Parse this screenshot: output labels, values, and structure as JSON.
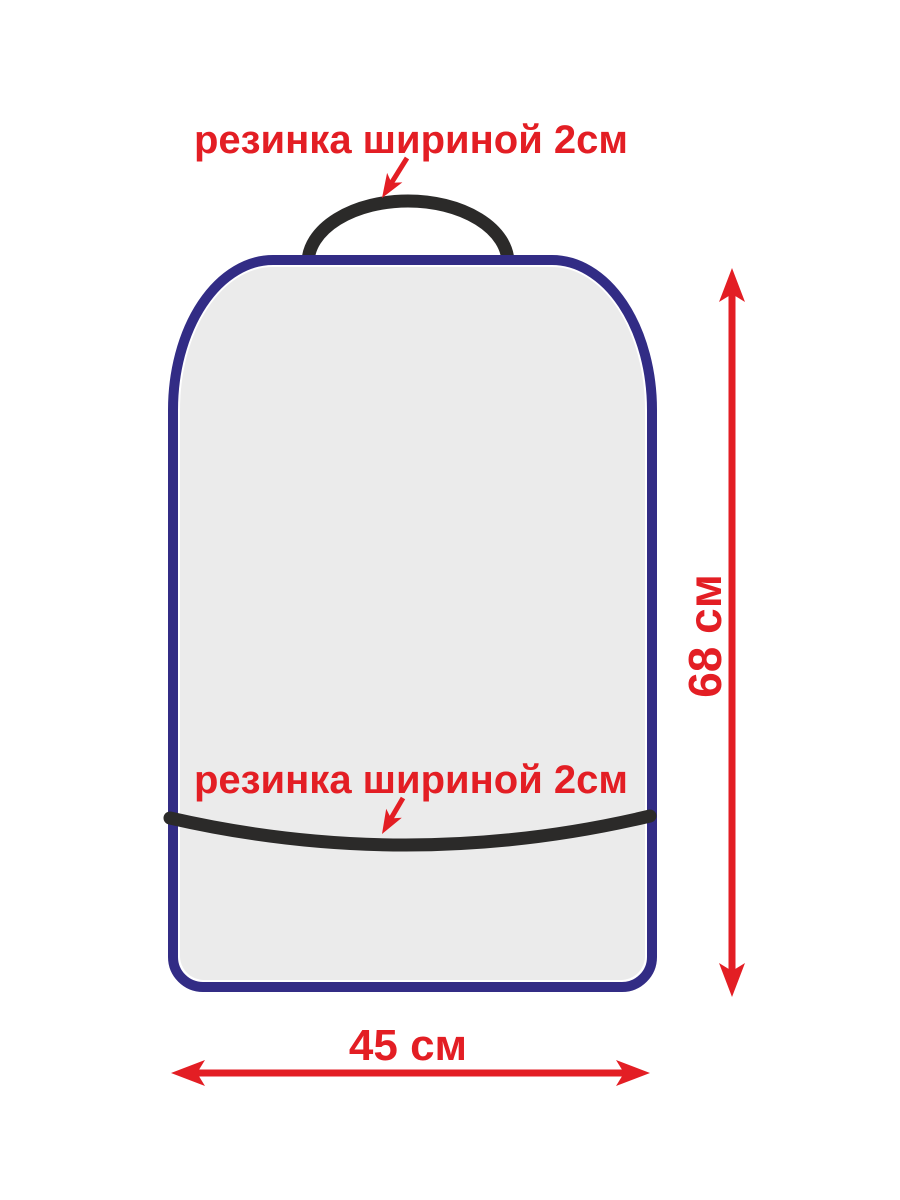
{
  "colors": {
    "red": "#e31e24",
    "blue": "#322c85",
    "gray": "#ebebeb",
    "black": "#2b2a29",
    "white": "#ffffff",
    "bg": "#ffffff"
  },
  "annotations": {
    "top_elastic": {
      "label": "резинка шириной 2см"
    },
    "bottom_elastic": {
      "label": "резинка шириной 2см"
    }
  },
  "dimensions": {
    "height": {
      "label": "68 см"
    },
    "width": {
      "label": "45 см"
    }
  }
}
